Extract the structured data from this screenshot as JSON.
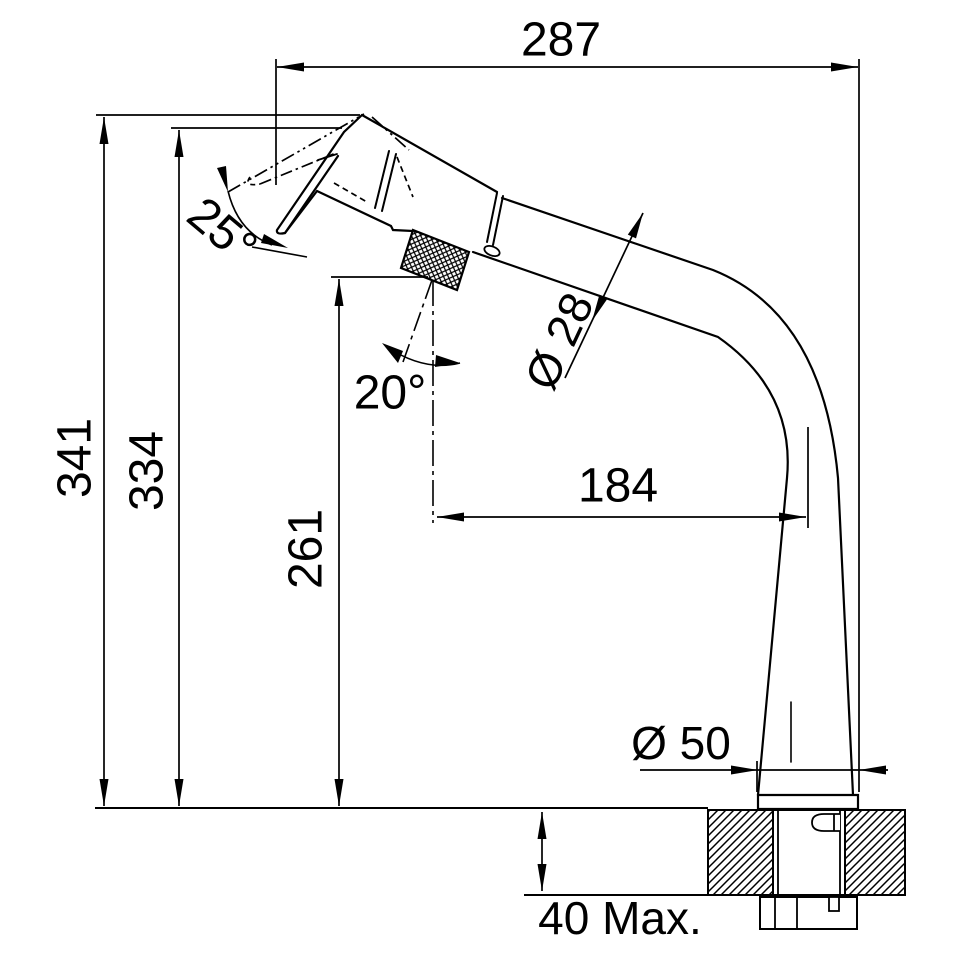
{
  "drawing": {
    "type": "technical-dimension-drawing",
    "subject": "kitchen pull-out spray faucet, side elevation with installation dimensions",
    "background_color": "#ffffff",
    "line_color": "#000000",
    "units": "mm",
    "labels": {
      "overall_reach": "287",
      "overall_height": "341",
      "spout_height": "334",
      "handle_height": "261",
      "spout_projection": "184",
      "spray_head_angle": "25°",
      "handle_swivel_angle": "20°",
      "spout_diameter": "Ø 28",
      "base_diameter": "Ø 50",
      "max_counter_thickness": "40 Max."
    }
  }
}
